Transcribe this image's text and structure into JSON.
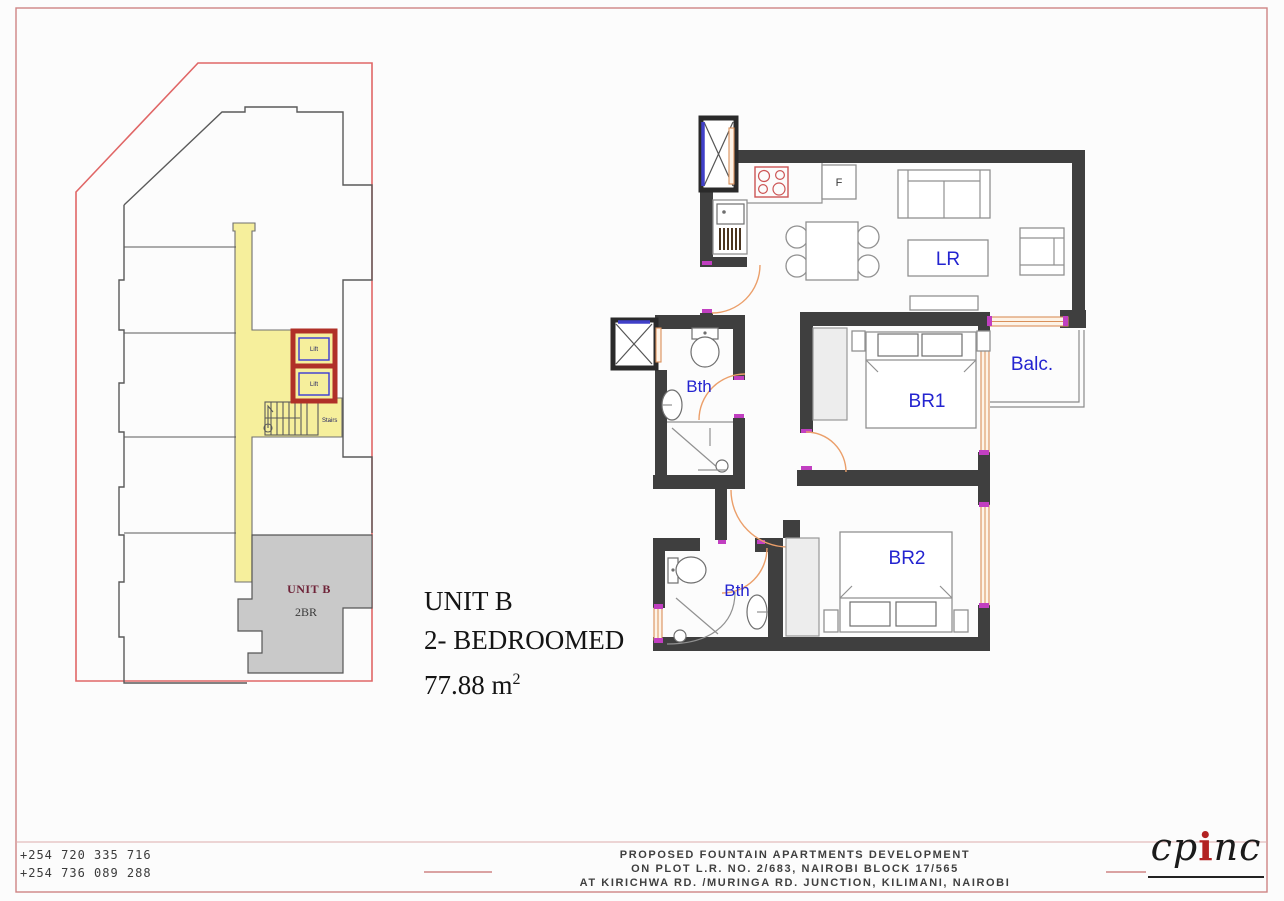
{
  "sheet": {
    "background": "#fcfcfc",
    "border_color": "#cf8484"
  },
  "key_plan": {
    "lifts": [
      {
        "label": "Lift"
      },
      {
        "label": "Lift"
      }
    ],
    "stairs_label": "Stairs",
    "unit_area_label": "UNIT B",
    "unit_area_sublabel": "2BR",
    "colors": {
      "corridor_yellow": "#f6ef9c",
      "unit_gray": "#c9c9c9",
      "lift_red": "#b03028",
      "boundary_red": "#e06666"
    }
  },
  "floor_plan": {
    "labels": {
      "living": "LR",
      "bedroom1": "BR1",
      "bedroom2": "BR2",
      "bath1": "Bth",
      "bath2": "Bth",
      "balcony": "Balc.",
      "fridge": "F"
    },
    "colors": {
      "wall": "#3f3f3f",
      "door_arc": "#eb9f6a",
      "window": "#d9905a",
      "label_blue": "#2424d0",
      "cooker_red": "#cc5555"
    }
  },
  "title": {
    "line1": "UNIT B",
    "line2": "2- BEDROOMED",
    "area_value": "77.88 m",
    "area_sup": "2"
  },
  "title_block": {
    "phone1": "+254 720 335 716",
    "phone2": "+254 736 089 288",
    "project_line1": "PROPOSED FOUNTAIN APARTMENTS DEVELOPMENT",
    "project_line2": "ON PLOT L.R. NO. 2/683, NAIROBI BLOCK 17/565",
    "project_line3": "AT KIRICHWA RD. /MURINGA RD. JUNCTION, KILIMANI, NAIROBI",
    "logo_part1": "cp",
    "logo_part2": "i",
    "logo_part3": "nc"
  }
}
